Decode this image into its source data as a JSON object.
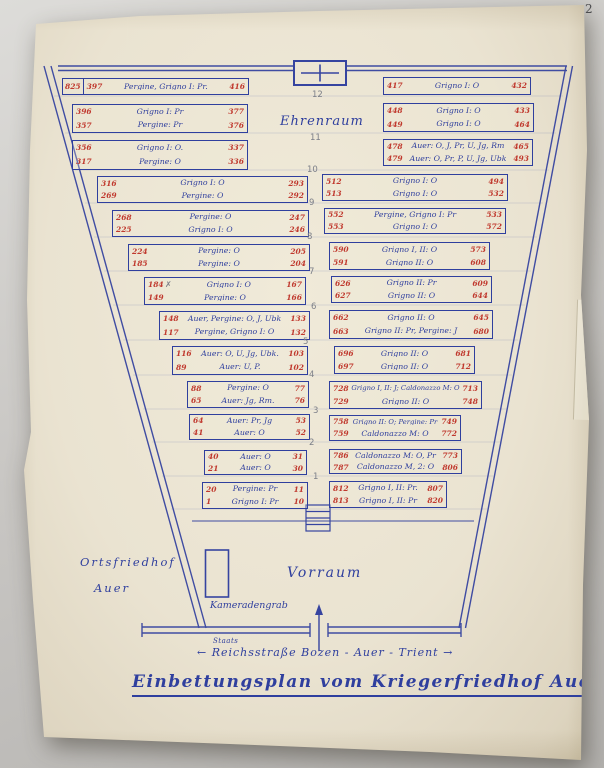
{
  "photo": {
    "corner_annotation": "2"
  },
  "title": {
    "text": "Einbettungsplan vom Kriegerfriedhof Auer"
  },
  "street": {
    "overwrite": "Staats",
    "text": "← Reichsstraße  Bozen - Auer - Trient →"
  },
  "areas": {
    "ehrenraum": "Ehrenraum",
    "vorraum": "Vorraum",
    "ortsfriedhof_line1": "Ortsfriedhof",
    "ortsfriedhof_line2": "Auer",
    "kameradengrab": "Kameradengrab"
  },
  "row_numbers": [
    "12",
    "11",
    "10",
    "9",
    "8",
    "7",
    "6",
    "5",
    "4",
    "3",
    "2",
    "1"
  ],
  "colors": {
    "ink_blue": "#2f3f9e",
    "ink_red": "#c0392e",
    "pencil": "#7c7f88",
    "paper": "#eae3d1",
    "background": "#c7c5c2"
  },
  "left": [
    {
      "extra": "825",
      "lines": [
        {
          "s": "397",
          "t": "Pergine, Grigno I: Pr.",
          "e": "416"
        }
      ]
    },
    {
      "lines": [
        {
          "s": "396",
          "t": "Grigno I: Pr",
          "e": "377"
        },
        {
          "s": "357",
          "t": "Pergine: Pr",
          "e": "376"
        }
      ]
    },
    {
      "lines": [
        {
          "s": "356",
          "t": "Grigno I: Ö.",
          "e": "337"
        },
        {
          "s": "317",
          "t": "Pergine: Ö",
          "e": "336"
        }
      ]
    },
    {
      "lines": [
        {
          "s": "316",
          "t": "Grigno I: Ö",
          "e": "293"
        },
        {
          "s": "269",
          "t": "Pergine: Ö",
          "e": "292"
        }
      ]
    },
    {
      "lines": [
        {
          "s": "268",
          "t": "Pergine: Ö",
          "e": "247"
        },
        {
          "s": "225",
          "t": "Grigno I: Ö",
          "e": "246"
        }
      ]
    },
    {
      "lines": [
        {
          "s": "224",
          "t": "Pergine: Ö",
          "e": "205"
        },
        {
          "s": "185",
          "t": "Pergine: Ö",
          "e": "204"
        }
      ]
    },
    {
      "mark": "✗",
      "lines": [
        {
          "s": "184",
          "t": "Grigno I: Ö",
          "e": "167"
        },
        {
          "s": "149",
          "t": "Pergine: Ö",
          "e": "166"
        }
      ]
    },
    {
      "lines": [
        {
          "s": "148",
          "t": "Auer, Pergine: Ö, J, Ubk",
          "e": "133"
        },
        {
          "s": "117",
          "t": "Pergine, Grigno I: Ö",
          "e": "132"
        }
      ]
    },
    {
      "lines": [
        {
          "s": "116",
          "t": "Auer: Ö, U, Jg, Ubk.",
          "e": "103"
        },
        {
          "s": "89",
          "t": "Auer: U, P.",
          "e": "102"
        }
      ]
    },
    {
      "lines": [
        {
          "s": "88",
          "t": "Pergine: Ö",
          "e": "77"
        },
        {
          "s": "65",
          "t": "Auer: Jg, Rm.",
          "e": "76"
        }
      ]
    },
    {
      "lines": [
        {
          "s": "64",
          "t": "Auer: Pr, Jg",
          "e": "53"
        },
        {
          "s": "41",
          "t": "Auer: Ö",
          "e": "52"
        }
      ]
    },
    {
      "lines": [
        {
          "s": "40",
          "t": "Auer: Ö",
          "e": "31"
        },
        {
          "s": "21",
          "t": "Auer: Ö",
          "e": "30"
        }
      ]
    },
    {
      "lines": [
        {
          "s": "20",
          "t": "Pergine: Pr",
          "e": "11"
        },
        {
          "s": "1",
          "t": "Grigno I: Pr",
          "e": "10"
        }
      ]
    }
  ],
  "right": [
    {
      "lines": [
        {
          "s": "417",
          "t": "Grigno I: Ö",
          "e": "432"
        }
      ]
    },
    {
      "lines": [
        {
          "s": "448",
          "t": "Grigno I: Ö",
          "e": "433"
        },
        {
          "s": "449",
          "t": "Grigno I: Ö",
          "e": "464"
        }
      ]
    },
    {
      "lines": [
        {
          "s": "478",
          "t": "Auer: Ö, J, Pr, U, Jg, Rm",
          "e": "465"
        },
        {
          "s": "479",
          "t": "Auer: Ö, Pr, P, U, Jg, Ubk",
          "e": "493"
        }
      ]
    },
    {
      "lines": [
        {
          "s": "512",
          "t": "Grigno I: Ö",
          "e": "494"
        },
        {
          "s": "513",
          "t": "Grigno I: Ö",
          "e": "532"
        }
      ]
    },
    {
      "lines": [
        {
          "s": "552",
          "t": "Pergine, Grigno I: Pr",
          "e": "533"
        },
        {
          "s": "553",
          "t": "Grigno I: Ö",
          "e": "572"
        }
      ]
    },
    {
      "lines": [
        {
          "s": "590",
          "t": "Grigno I, II: Ö",
          "e": "573"
        },
        {
          "s": "591",
          "t": "Grigno II: Ö",
          "e": "608"
        }
      ]
    },
    {
      "lines": [
        {
          "s": "626",
          "t": "Grigno II: Pr",
          "e": "609"
        },
        {
          "s": "627",
          "t": "Grigno II: Ö",
          "e": "644"
        }
      ]
    },
    {
      "lines": [
        {
          "s": "662",
          "t": "Grigno II: Ö",
          "e": "645"
        },
        {
          "s": "663",
          "t": "Grigno II: Pr, Pergine: J",
          "e": "680"
        }
      ]
    },
    {
      "lines": [
        {
          "s": "696",
          "t": "Grigno II: Ö",
          "e": "681"
        },
        {
          "s": "697",
          "t": "Grigno II: Ö",
          "e": "712"
        }
      ]
    },
    {
      "lines": [
        {
          "s": "728",
          "t": "Grigno I, II: J; Caldonazzo M: Ö",
          "e": "713"
        },
        {
          "s": "729",
          "t": "Grigno II: Ö",
          "e": "748"
        }
      ]
    },
    {
      "lines": [
        {
          "s": "758",
          "t": "Grigno II: Ö; Pergine: Pr",
          "e": "749"
        },
        {
          "s": "759",
          "t": "Caldonazzo M: Ö",
          "e": "772"
        }
      ]
    },
    {
      "lines": [
        {
          "s": "786",
          "t": "Caldonazzo M: Ö, Pr",
          "e": "773"
        },
        {
          "s": "787",
          "t": "Caldonazzo M, 2: Ö",
          "e": "806"
        }
      ]
    },
    {
      "lines": [
        {
          "s": "812",
          "t": "Grigno I, II: Pr.",
          "e": "807"
        },
        {
          "s": "813",
          "t": "Grigno I, II: Pr",
          "e": "820"
        }
      ]
    }
  ]
}
